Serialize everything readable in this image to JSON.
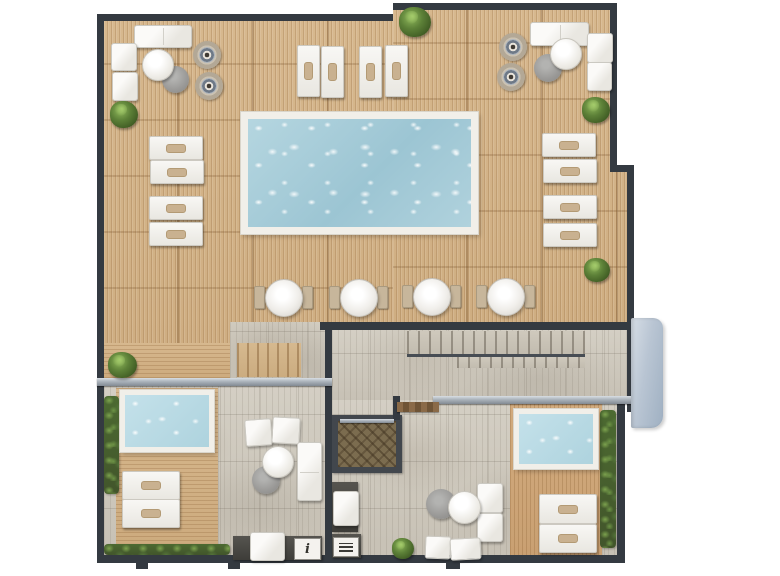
{
  "meta": {
    "title": "Rooftop terrace floor plan",
    "view": "top-down architectural 3D render",
    "canvas": {
      "width": 780,
      "height": 576
    }
  },
  "labels": {
    "info_plaque": "i"
  },
  "palette": {
    "wall": "#343a41",
    "deck_wood": "#d7b88e",
    "stone_tile": "#d4cfc4",
    "pool_water": "#b5d6e0",
    "plunge_water": "#c4e1ea",
    "railing": "#aab2ba",
    "hedge": "#4c6a31",
    "plant_green": "#5d8138",
    "table_gray": "#9a9997",
    "pillow_tan": "#c9b190",
    "annex_block": "#b9c5d3",
    "door_wood": "#6f5436"
  },
  "zones": [
    {
      "id": "pool-deck",
      "name": "Main timber pool deck"
    },
    {
      "id": "main-pool",
      "name": "Swimming pool"
    },
    {
      "id": "lounge-top-left",
      "name": "Lounge cluster (sofa, armchairs, tables, round daybeds)"
    },
    {
      "id": "lounge-top-right",
      "name": "Lounge cluster (sofa, armchairs, tables, round daybeds)"
    },
    {
      "id": "umbrella-table-row",
      "name": "Row of four round tables with side seats"
    },
    {
      "id": "stair-corridor",
      "name": "Stone corridor with staircase"
    },
    {
      "id": "suite-left",
      "name": "Private terrace with plunge pool and hedges"
    },
    {
      "id": "suite-middle",
      "name": "Lounge terrace with parquet vestibule and kitchenette"
    },
    {
      "id": "suite-right",
      "name": "Private terrace with plunge pool and hedge"
    },
    {
      "id": "annex-block",
      "name": "Exterior annex volume (east side)"
    }
  ],
  "inventory": {
    "pools": 1,
    "plunge_pools": 2,
    "sun_loungers_flat": 12,
    "sun_loungers_upright": 4,
    "round_tables_row": 4,
    "ring_daybeds": 4,
    "sofas": 3,
    "armchairs": 8,
    "coffee_tables_white": 4,
    "coffee_tables_gray": 4,
    "plants": 6,
    "hedge_strips": 3,
    "kitchenette_counters": 3
  }
}
